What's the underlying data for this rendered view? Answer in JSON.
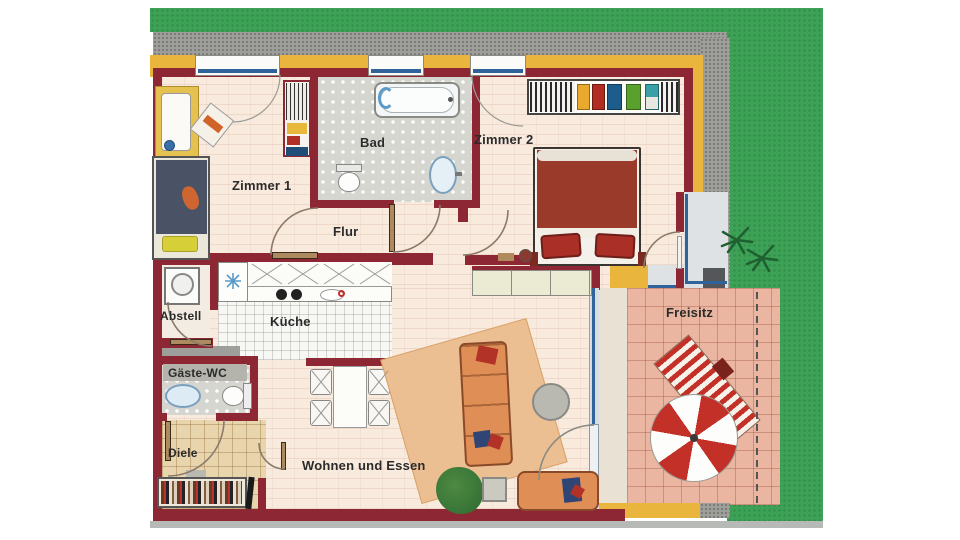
{
  "rooms": {
    "zimmer1": {
      "label": "Zimmer 1"
    },
    "bad": {
      "label": "Bad"
    },
    "zimmer2": {
      "label": "Zimmer 2"
    },
    "flur": {
      "label": "Flur"
    },
    "abstell": {
      "label": "Abstell"
    },
    "kueche": {
      "label": "Küche"
    },
    "gaeste_wc": {
      "label": "Gäste-WC"
    },
    "diele": {
      "label": "Diele"
    },
    "wohnen_und_essen": {
      "label": "Wohnen und Essen"
    },
    "freisitz": {
      "label": "Freisitz"
    }
  },
  "colors": {
    "wall": "#8c2733",
    "insulation_band": "#e9b53d",
    "grass": "#3da156",
    "gravel_path": "#9e9e9a",
    "interior_floor": "#f9eade",
    "bath_tile": "#d6d6d0",
    "kitchen_tile": "#f7f7f4",
    "hall_tile": "#e8d5ae",
    "terrace_tile": "#ebb6a1",
    "window_frame": "#2f6399",
    "umbrella_red": "#c23028",
    "sofa_orange": "#df8f56",
    "bed2_blanket": "#993a2b",
    "bed1_blanket": "#4a5366"
  }
}
